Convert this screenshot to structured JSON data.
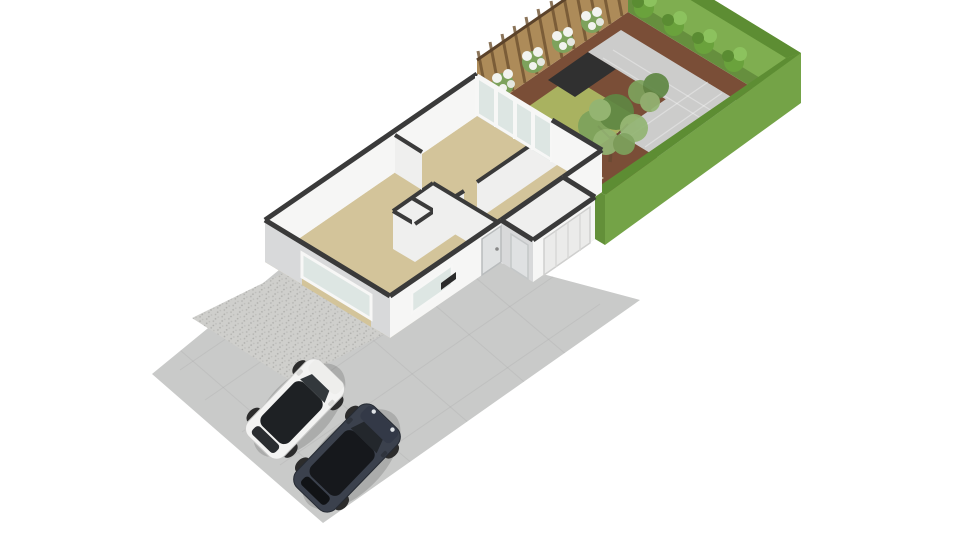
{
  "meta": {
    "type": "3d-floorplan-render",
    "description": "Isometric 3D floor plan render of a single-storey house with a front driveway, two parked SUVs and a landscaped walled back garden on a white background",
    "background": "#ffffff"
  },
  "colors": {
    "background": "#ffffff",
    "driveway": "#c9cac9",
    "gravel": "#cfcfcc",
    "gravel_speck": "#b5b5b2",
    "floor_tan": "#d3c49a",
    "garage_floor": "#d6d7d5",
    "wall_top": "#3a3a3a",
    "wall_face_bright": "#f6f6f5",
    "wall_face_shaded": "#d8d9da",
    "wall_face_interior": "#efefee",
    "glass": "#dde6e3",
    "window_frame": "#f7f7f6",
    "door_panel": "#dfe1e2",
    "garage_door": "#ebebea",
    "mulch": "#7a4e37",
    "lawn": "#a9b260",
    "patio_dark": "#303030",
    "paving_gray": "#cccccb",
    "terrace_beige": "#cec2a4",
    "fence_wood": "#ad8b59",
    "fence_slat": "#6f5230",
    "hedge_outer_bright": "#7fae50",
    "hedge_outer_front": "#74a347",
    "hedge_top": "#5d8d33",
    "hedge_inner": "#668f3e",
    "tree_green_dark": "#5f8743",
    "tree_green_mid": "#7da25c",
    "tree_green_light": "#93b573",
    "trunk_brown": "#6b4a33",
    "bush_green": "#6aa23c",
    "bush_green_light": "#8cc25e",
    "blossom_white": "#f2f3ef",
    "grass_tuft": "#8a5c49",
    "car_white_body": "#f3f3f2",
    "car_white_hood": "#eeeeec",
    "car_glass_dark": "#1e2124",
    "car_dark_body": "#3b414d",
    "car_dark_roof": "#16181c",
    "car_dark_hood": "#333947",
    "wheel_dark": "#2c2c2c",
    "shadow": "rgba(0,0,0,0.15)",
    "tv_dark": "#2b2b2b"
  },
  "scene": {
    "driveway": {
      "surfaces": [
        "smooth-paving",
        "gravel-patch"
      ],
      "vehicle_count": 2,
      "vehicles": [
        {
          "name": "white-suv",
          "color_key": "car_white_body"
        },
        {
          "name": "dark-suv",
          "color_key": "car_dark_body"
        }
      ]
    },
    "house": {
      "storeys_shown": 1,
      "rooms": [
        "living-room",
        "hallway",
        "wc",
        "storage",
        "kitchen-diner",
        "bedroom",
        "garage",
        "sunroom"
      ],
      "features": [
        "front-door",
        "left-window",
        "front-window",
        "garage-door",
        "garage-side-door",
        "sunroom-glazing",
        "tv-unit"
      ]
    },
    "garden": {
      "features": [
        "lawn",
        "dark-patio",
        "paving",
        "terrace",
        "mulch-borders",
        "wood-fence",
        "hedge-border",
        "trees",
        "hedge-bushes",
        "flowering-shrubs",
        "ornamental-grasses"
      ],
      "counts": {
        "trees": 2,
        "hedge_bushes": 4,
        "flowering_shrubs": 4,
        "grass_tufts": 3
      }
    }
  }
}
